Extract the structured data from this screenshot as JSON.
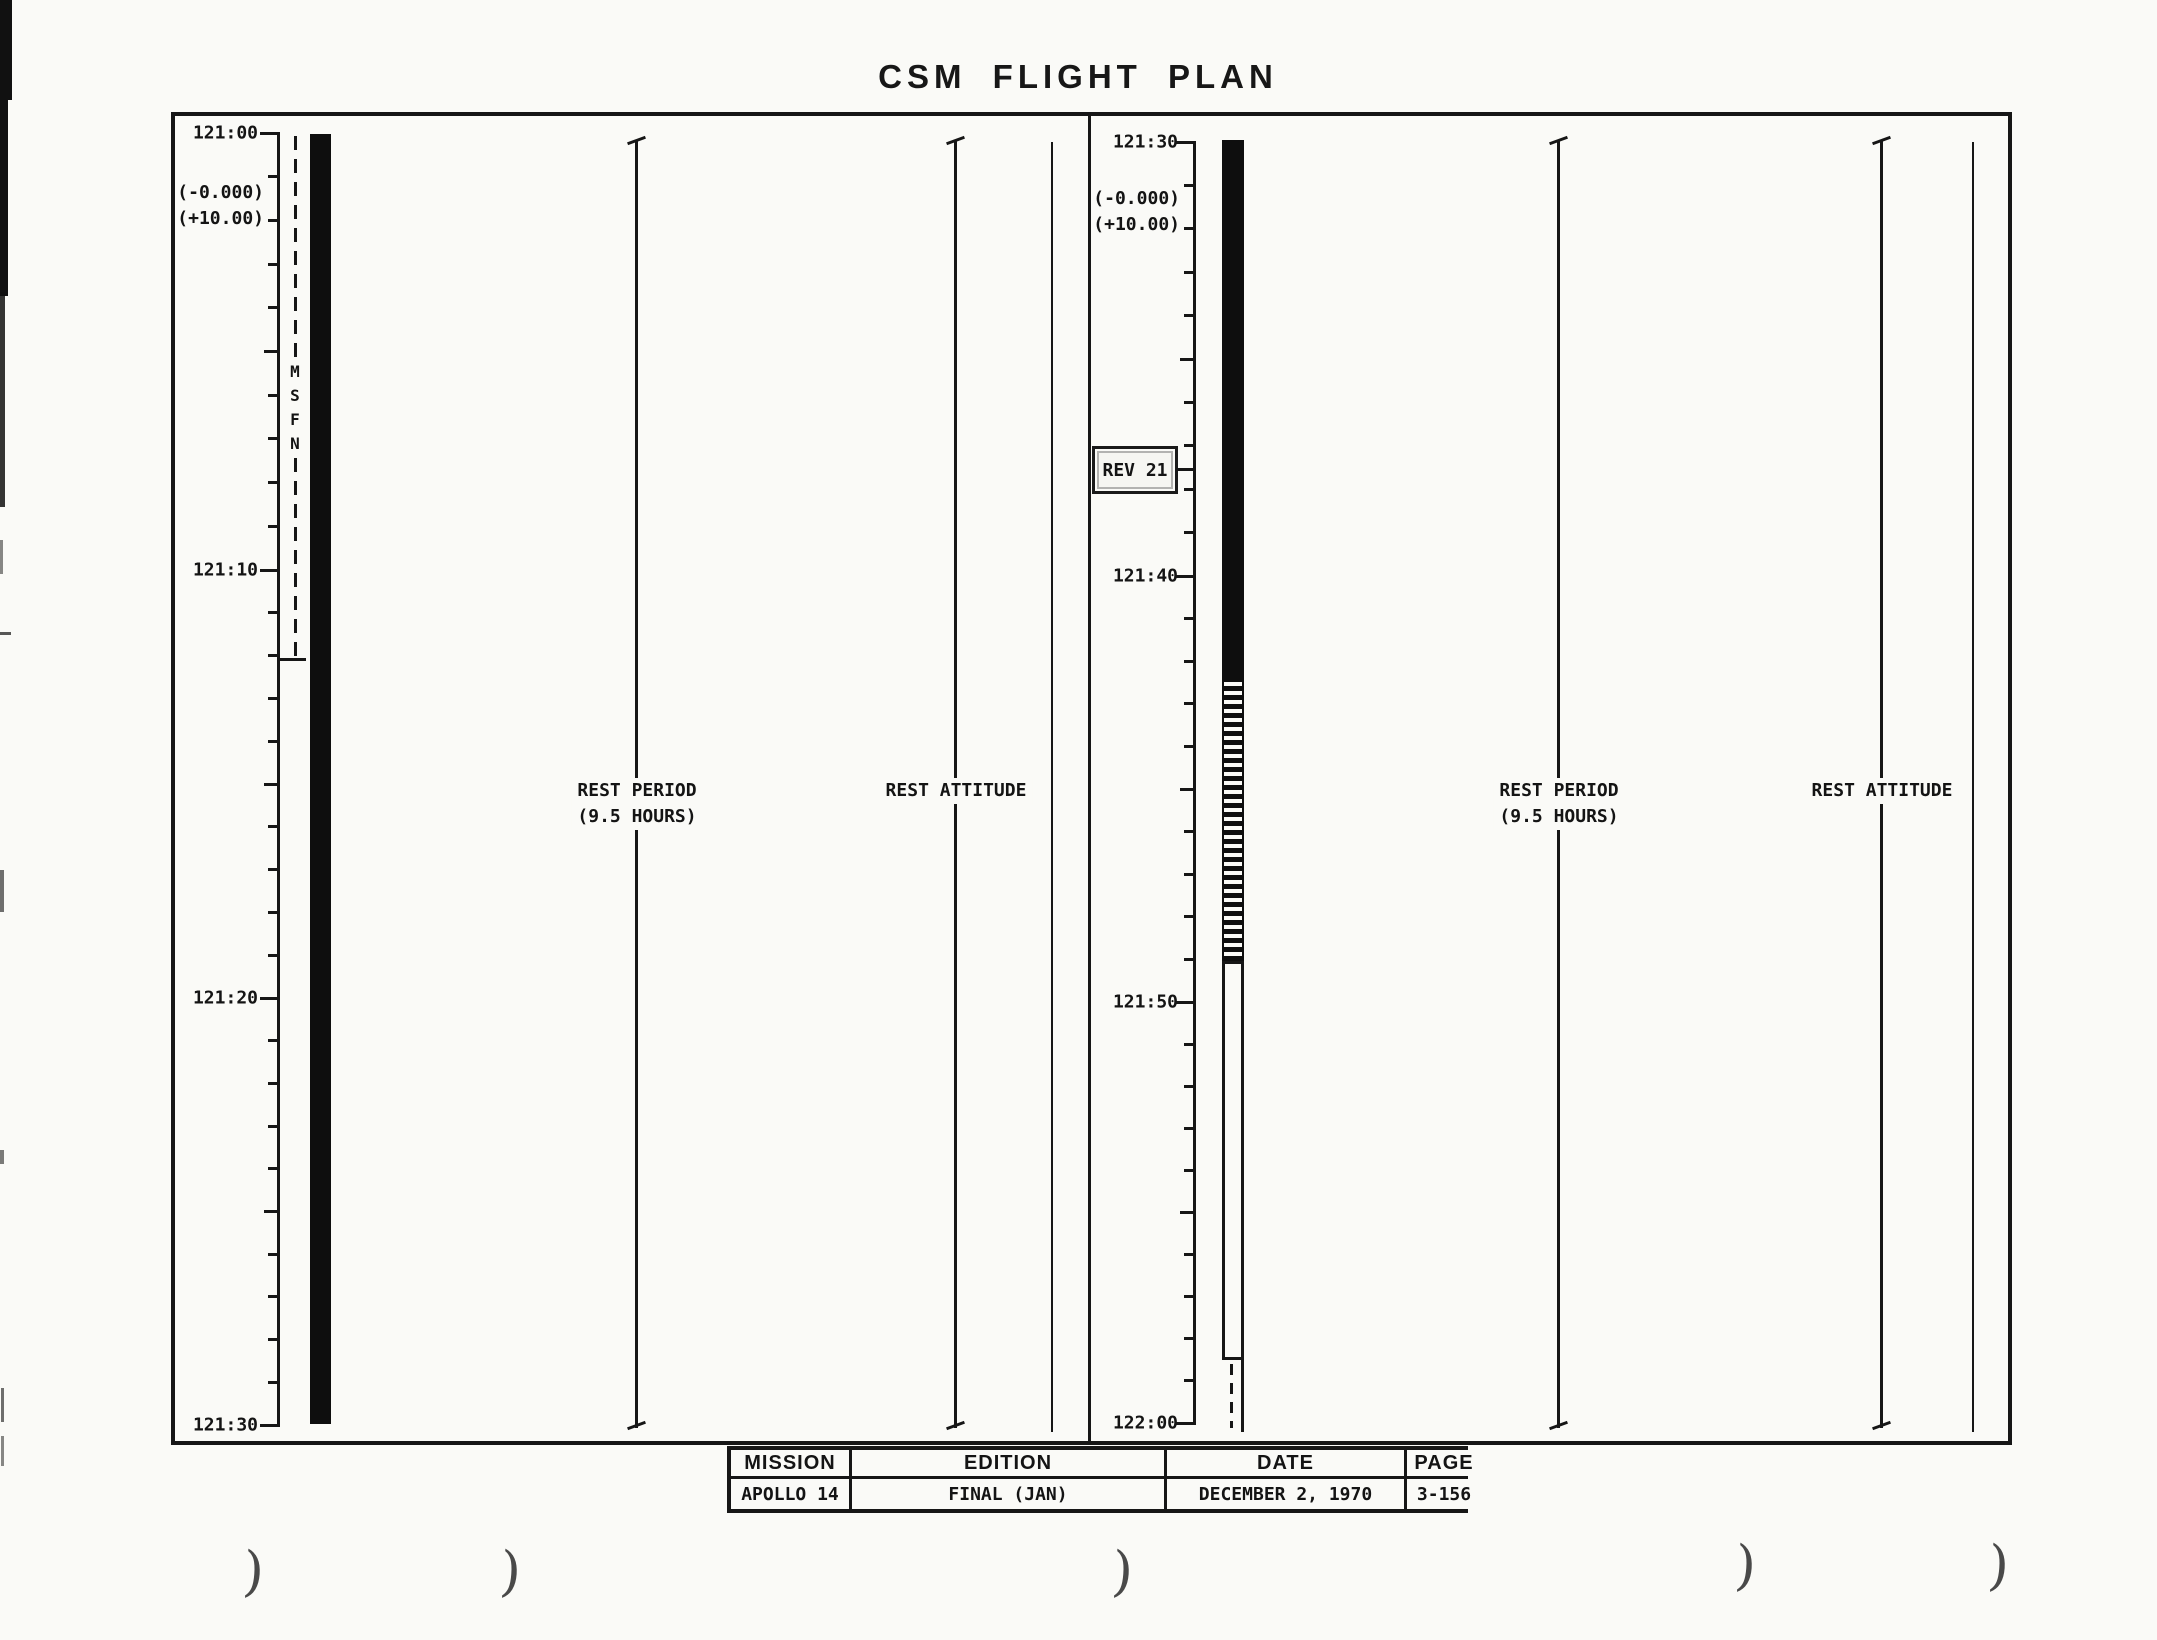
{
  "page": {
    "title": "CSM FLIGHT PLAN"
  },
  "left_panel": {
    "time_labels": [
      "121:00",
      "121:10",
      "121:20",
      "121:30"
    ],
    "attitude_values": [
      "(-0.000)",
      "(+10.00)"
    ],
    "msfn_label": "MSFN",
    "rest_period": {
      "label": "REST PERIOD",
      "duration": "(9.5 HOURS)"
    },
    "rest_attitude": {
      "label": "REST ATTITUDE"
    }
  },
  "right_panel": {
    "time_labels": [
      "121:30",
      "121:40",
      "121:50",
      "122:00"
    ],
    "attitude_values": [
      "(-0.000)",
      "(+10.00)"
    ],
    "rev_badge": "REV 21",
    "rest_period": {
      "label": "REST PERIOD",
      "duration": "(9.5 HOURS)"
    },
    "rest_attitude": {
      "label": "REST ATTITUDE"
    }
  },
  "footer_table": {
    "headers": [
      "MISSION",
      "EDITION",
      "DATE",
      "PAGE"
    ],
    "values": [
      "APOLLO 14",
      "FINAL (JAN)",
      "DECEMBER 2, 1970",
      "3-156"
    ]
  },
  "colors": {
    "ink": "#161616",
    "paper": "#fafaf7"
  }
}
